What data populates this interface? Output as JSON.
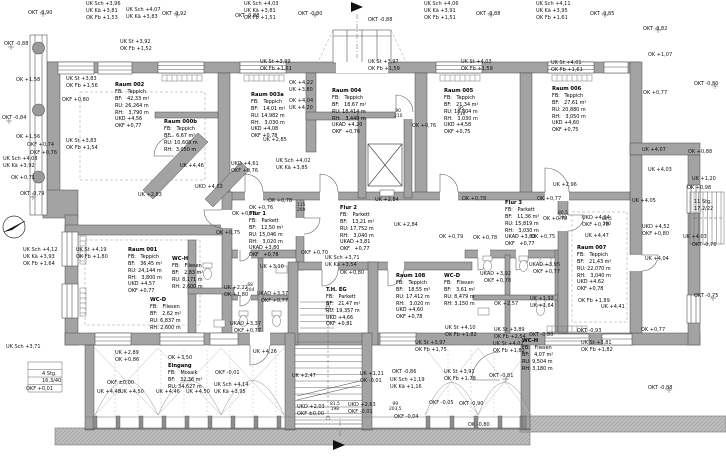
{
  "drawing": {
    "kind": "architectural floor plan",
    "floor_label": "EG"
  },
  "colors": {
    "wall": "#a3a3a3",
    "wall_outline": "#4a4a4a",
    "line": "#3f3f3f",
    "ground": "#bdbdbd",
    "background": "#ffffff"
  },
  "rooms": [
    {
      "name": "Raum 002",
      "x": 115,
      "y": 82,
      "lines": [
        "FB:   Teppich",
        "BF:   42,33 m²",
        "RU: 26,264 m",
        "RH:   3,790 m",
        "UKD +4,56",
        "OKF +0,77"
      ]
    },
    {
      "name": "Raum 000b",
      "x": 164,
      "y": 119,
      "lines": [
        "FB:   Teppich",
        "BF:   6,67 m²",
        "RU: 10,608 m",
        "RH:  3,050 m"
      ]
    },
    {
      "name": "Raum 003a",
      "x": 251,
      "y": 92,
      "lines": [
        "FB:   Teppich",
        "BF:   14,01 m²",
        "RU: 14,982 m",
        "RH:   3,030 m",
        "UKD +4,08",
        "OKF +0,78"
      ]
    },
    {
      "name": "Raum 004",
      "x": 332,
      "y": 88,
      "lines": [
        "FB:   Teppich",
        "BF:   18,67 m²",
        "RU: 18,414 m",
        "RH:   3,440 m",
        "UKAD +4,20",
        "OKF  +0,76"
      ]
    },
    {
      "name": "Raum 005",
      "x": 444,
      "y": 88,
      "lines": [
        "FB:   Teppich",
        "BF:   21,34 m²",
        "RU: 18,804 m",
        "RH:   3,030 m",
        "UKD +4,58",
        "OKF +0,75"
      ]
    },
    {
      "name": "Raum 006",
      "x": 552,
      "y": 86,
      "lines": [
        "FB:   Teppich",
        "BF:   27,61 m²",
        "RU: 20,880 m",
        "RH:   3,050 m",
        "UKD +4,60",
        "OKF +0,75"
      ]
    },
    {
      "name": "Raum 001",
      "x": 128,
      "y": 247,
      "lines": [
        "FB:   Teppich",
        "BF:   36,45 m²",
        "RU: 24,144 m",
        "RH:   3,800 m",
        "UKD +4,57",
        "OKF +0,77"
      ]
    },
    {
      "name": "WC-H",
      "x": 172,
      "y": 256,
      "lines": [
        "FB:   Fliesen",
        "BF:   2,83 m²",
        "RU: 8,171 m",
        "RH: 2,600 m"
      ]
    },
    {
      "name": "WC-D",
      "x": 150,
      "y": 297,
      "lines": [
        "FB:   Fliesen",
        "BF:   2,62 m²",
        "RU: 6,837 m",
        "RH: 2,600 m"
      ]
    },
    {
      "name": "Flur 1",
      "x": 249,
      "y": 211,
      "lines": [
        "FB:   Parkett",
        "BF:   12,50 m²",
        "RU: 15,046 m",
        "RH:   3,020 m",
        "UKAD +3,80",
        "OKF   +0,78"
      ]
    },
    {
      "name": "Flur 2",
      "x": 340,
      "y": 205,
      "lines": [
        "FB:   Parkett",
        "BF:   13,21 m²",
        "RU: 17,752 m",
        "RH:   3,040 m",
        "UKAD +3,81",
        "OKF   +0,77"
      ]
    },
    {
      "name": "Flur 3",
      "x": 505,
      "y": 200,
      "lines": [
        "FB:   Parkett",
        "BF:   11,36 m²",
        "RU: 15,819 m",
        "RH:   3,030 m",
        "UKAD +3,80",
        "OKF   +0,77"
      ]
    },
    {
      "name": "T.H. EG",
      "x": 326,
      "y": 287,
      "lines": [
        "FB:   Parkett",
        "BF:   21,47 m²",
        "RU: 19,357 m",
        "",
        "UKD +4,66",
        "OKF +0,81"
      ]
    },
    {
      "name": "Raum 108",
      "x": 396,
      "y": 273,
      "lines": [
        "FB:   Teppich",
        "BF:   18,55 m²",
        "RU: 17,412 m",
        "RH:   3,020 m",
        "UKD +4,60",
        "OKF +0,78"
      ]
    },
    {
      "name": "WC-D",
      "x": 444,
      "y": 273,
      "lines": [
        "FB:   Fliesen",
        "BF:   3,61 m²",
        "RU: 8,479 m",
        "RH: 3,150 m"
      ]
    },
    {
      "name": "WC-H",
      "x": 522,
      "y": 338,
      "lines": [
        "FB:   Fliesen",
        "BF:   4,07 m²",
        "RU: 9,504 m",
        "RH: 3,180 m"
      ]
    },
    {
      "name": "Raum 007",
      "x": 577,
      "y": 245,
      "lines": [
        "FB:   Teppich",
        "BF:   21,43 m²",
        "RU: 22,070 m",
        "RH:   3,040 m",
        "UKD +4,62",
        "OKF +0,78"
      ]
    },
    {
      "name": "Eingang",
      "x": 168,
      "y": 363,
      "lines": [
        "FB:   Mosaik",
        "BF:   32,36 m²",
        "RU: 34,627 m"
      ]
    }
  ],
  "annotations": [
    {
      "text": "OKT -0,90",
      "x": 28,
      "y": 11
    },
    {
      "text": "UK Sch +3,96",
      "x": 86,
      "y": 2
    },
    {
      "text": "UK Kä  +3,81",
      "x": 86,
      "y": 9
    },
    {
      "text": "OK Fb  +1,53",
      "x": 86,
      "y": 16
    },
    {
      "text": "UK Sch +4,07",
      "x": 126,
      "y": 8
    },
    {
      "text": "UK Kä  +3,83",
      "x": 126,
      "y": 15
    },
    {
      "text": "OKT -0,92",
      "x": 162,
      "y": 12
    },
    {
      "text": "UK Sch +4,03",
      "x": 244,
      "y": 2
    },
    {
      "text": "UK Kä  +3,81",
      "x": 244,
      "y": 9
    },
    {
      "text": "OK Fb  +1,51",
      "x": 244,
      "y": 16
    },
    {
      "text": "OKT -0,88",
      "x": 235,
      "y": 14
    },
    {
      "text": "OKT -0,80",
      "x": 298,
      "y": 12
    },
    {
      "text": "OKT -0,88",
      "x": 368,
      "y": 18
    },
    {
      "text": "UK Sch +4,06",
      "x": 424,
      "y": 2
    },
    {
      "text": "UK Kä  +3,91",
      "x": 424,
      "y": 9
    },
    {
      "text": "OK Fb  +1,51",
      "x": 424,
      "y": 16
    },
    {
      "text": "OKT -0,88",
      "x": 476,
      "y": 12
    },
    {
      "text": "UK Sch +4,11",
      "x": 536,
      "y": 2
    },
    {
      "text": "UK Kä  +3,95",
      "x": 536,
      "y": 9
    },
    {
      "text": "OK Fb  +1,61",
      "x": 536,
      "y": 16
    },
    {
      "text": "OKT -0,85",
      "x": 590,
      "y": 12
    },
    {
      "text": "OKT -0,82",
      "x": 643,
      "y": 27
    },
    {
      "text": "OK +1,07",
      "x": 648,
      "y": 53
    },
    {
      "text": "UK St +3,92",
      "x": 120,
      "y": 40
    },
    {
      "text": "OK Fb +1,52",
      "x": 120,
      "y": 47
    },
    {
      "text": "UK St +3,99",
      "x": 260,
      "y": 60
    },
    {
      "text": "OK Fb +1,61",
      "x": 260,
      "y": 67
    },
    {
      "text": "UK St +3,97",
      "x": 368,
      "y": 60
    },
    {
      "text": "OK Fb +1,59",
      "x": 368,
      "y": 67
    },
    {
      "text": "UK St +4,03",
      "x": 461,
      "y": 60
    },
    {
      "text": "OK Fb +1,59",
      "x": 461,
      "y": 67
    },
    {
      "text": "UK St +4,01",
      "x": 551,
      "y": 61
    },
    {
      "text": "OK Fb +1,61",
      "x": 551,
      "y": 68
    },
    {
      "text": "OKT -0,88",
      "x": 4,
      "y": 42
    },
    {
      "text": "OK +1,58",
      "x": 16,
      "y": 78
    },
    {
      "text": "UK St +3,83",
      "x": 66,
      "y": 77
    },
    {
      "text": "OK Fb +1,56",
      "x": 66,
      "y": 84
    },
    {
      "text": "OKF +0,80",
      "x": 62,
      "y": 98
    },
    {
      "text": "OKT -0,84",
      "x": 2,
      "y": 116
    },
    {
      "text": "OK +1,56",
      "x": 16,
      "y": 135
    },
    {
      "text": "OKF +0,74",
      "x": 27,
      "y": 143
    },
    {
      "text": "OKF +0,76",
      "x": 30,
      "y": 151
    },
    {
      "text": "UK St +3,83",
      "x": 66,
      "y": 139
    },
    {
      "text": "OK Fb +1,54",
      "x": 66,
      "y": 146
    },
    {
      "text": "UK Sch +4,08",
      "x": 3,
      "y": 157
    },
    {
      "text": "UK Kä  +3,92",
      "x": 3,
      "y": 164
    },
    {
      "text": "OK +0,71",
      "x": 11,
      "y": 176
    },
    {
      "text": "OKT -0,79",
      "x": 20,
      "y": 192
    },
    {
      "text": "UK Sch +4,12",
      "x": 23,
      "y": 248
    },
    {
      "text": "UK Kä  +3,93",
      "x": 23,
      "y": 255
    },
    {
      "text": "OK Fb  +1,64",
      "x": 23,
      "y": 262
    },
    {
      "text": "UK St +4,19",
      "x": 76,
      "y": 248
    },
    {
      "text": "OK Fb +1,80",
      "x": 76,
      "y": 255
    },
    {
      "text": "UK +4,46",
      "x": 180,
      "y": 164
    },
    {
      "text": "UKD +4,63",
      "x": 195,
      "y": 185
    },
    {
      "text": "UK +2,83",
      "x": 138,
      "y": 193
    },
    {
      "text": "UKD +4,61",
      "x": 231,
      "y": 162
    },
    {
      "text": "OKF +0,76",
      "x": 231,
      "y": 169
    },
    {
      "text": "UK Sch +4,02",
      "x": 276,
      "y": 159
    },
    {
      "text": "UK Kä  +3,85",
      "x": 276,
      "y": 166
    },
    {
      "text": "OK +4,22",
      "x": 289,
      "y": 81
    },
    {
      "text": "UK +3,80",
      "x": 289,
      "y": 88
    },
    {
      "text": "OK +4,04",
      "x": 289,
      "y": 99
    },
    {
      "text": "UK +4,20",
      "x": 289,
      "y": 106
    },
    {
      "text": "UK +2,85",
      "x": 263,
      "y": 138
    },
    {
      "text": "OK +0,76",
      "x": 249,
      "y": 206
    },
    {
      "text": "OK +0,78",
      "x": 232,
      "y": 212
    },
    {
      "text": "OK +0,75",
      "x": 216,
      "y": 231
    },
    {
      "text": "OK +0,78",
      "x": 268,
      "y": 199
    },
    {
      "text": "UK +2,84",
      "x": 375,
      "y": 198
    },
    {
      "text": "UK +2,84",
      "x": 394,
      "y": 223
    },
    {
      "text": "OK +0,76",
      "x": 412,
      "y": 124
    },
    {
      "text": "OK +0,78",
      "x": 462,
      "y": 197
    },
    {
      "text": "OK +0,77",
      "x": 537,
      "y": 197
    },
    {
      "text": "OK +0,78",
      "x": 543,
      "y": 217
    },
    {
      "text": "OK +0,79",
      "x": 439,
      "y": 235
    },
    {
      "text": "OK +0,78",
      "x": 473,
      "y": 236
    },
    {
      "text": "OK +0,75",
      "x": 531,
      "y": 235
    },
    {
      "text": "UK Sch +3,71",
      "x": 325,
      "y": 256
    },
    {
      "text": "UK Kä  +3,54",
      "x": 325,
      "y": 263
    },
    {
      "text": "OK +0,80",
      "x": 340,
      "y": 271
    },
    {
      "text": "UK +3,10",
      "x": 260,
      "y": 265
    },
    {
      "text": "OKF +0,70",
      "x": 301,
      "y": 251
    },
    {
      "text": "UK +2,22",
      "x": 224,
      "y": 286
    },
    {
      "text": "OK +1,80",
      "x": 224,
      "y": 293
    },
    {
      "text": "UKAD +3,37",
      "x": 257,
      "y": 292
    },
    {
      "text": "OKF   +0,77",
      "x": 261,
      "y": 299
    },
    {
      "text": "UKAD +3,37",
      "x": 230,
      "y": 322
    },
    {
      "text": "OKF   +0,77",
      "x": 234,
      "y": 329
    },
    {
      "text": "UKAD +3,95",
      "x": 529,
      "y": 263
    },
    {
      "text": "OKF   +0,77",
      "x": 533,
      "y": 270
    },
    {
      "text": "UKAD +3,92",
      "x": 480,
      "y": 272
    },
    {
      "text": "OKF   +0,78",
      "x": 484,
      "y": 279
    },
    {
      "text": "OK +2,57",
      "x": 494,
      "y": 302
    },
    {
      "text": "UK +1,92",
      "x": 530,
      "y": 297
    },
    {
      "text": "UK +1,64",
      "x": 530,
      "y": 304
    },
    {
      "text": "UKD +4,64",
      "x": 582,
      "y": 216
    },
    {
      "text": "OKF +0,78",
      "x": 582,
      "y": 223
    },
    {
      "text": "UK +4,47",
      "x": 585,
      "y": 234
    },
    {
      "text": "UKD +4,52",
      "x": 642,
      "y": 225
    },
    {
      "text": "OKF +0,80",
      "x": 642,
      "y": 232
    },
    {
      "text": "UK +4,04",
      "x": 645,
      "y": 257
    },
    {
      "text": "UK +4,05",
      "x": 632,
      "y": 199
    },
    {
      "text": "UK +4,03",
      "x": 648,
      "y": 168
    },
    {
      "text": "UK +4,07",
      "x": 642,
      "y": 148
    },
    {
      "text": "OK +0,88",
      "x": 688,
      "y": 150
    },
    {
      "text": "UK +1,20",
      "x": 692,
      "y": 177
    },
    {
      "text": "OK +0,98",
      "x": 687,
      "y": 186
    },
    {
      "text": "UK +2,96",
      "x": 553,
      "y": 183
    },
    {
      "text": "OK +0,77",
      "x": 643,
      "y": 91
    },
    {
      "text": "OKT -0,80",
      "x": 694,
      "y": 82
    },
    {
      "text": "UK +4,03",
      "x": 683,
      "y": 235
    },
    {
      "text": "OKT -0,76",
      "x": 692,
      "y": 243
    },
    {
      "text": "OKT -0,75",
      "x": 694,
      "y": 294
    },
    {
      "text": "OK Fb +1,89",
      "x": 578,
      "y": 299
    },
    {
      "text": "UK +4,41",
      "x": 601,
      "y": 305
    },
    {
      "text": "OK +0,77",
      "x": 641,
      "y": 328
    },
    {
      "text": "OKT -0,88",
      "x": 648,
      "y": 386
    },
    {
      "text": "11 Stg.",
      "x": 694,
      "y": 200
    },
    {
      "text": "17,2/22",
      "x": 694,
      "y": 207
    },
    {
      "text": "UK St +4,10",
      "x": 445,
      "y": 326
    },
    {
      "text": "OK Fb +1,82",
      "x": 445,
      "y": 333
    },
    {
      "text": "UK St +3,97",
      "x": 415,
      "y": 341
    },
    {
      "text": "OK Fb +1,75",
      "x": 415,
      "y": 348
    },
    {
      "text": "UK St +3,89",
      "x": 494,
      "y": 328
    },
    {
      "text": "OK Fb +2,54",
      "x": 494,
      "y": 335
    },
    {
      "text": "UK St +4,02",
      "x": 493,
      "y": 342
    },
    {
      "text": "OK Fb +1,82",
      "x": 493,
      "y": 349
    },
    {
      "text": "UK St +3,91",
      "x": 444,
      "y": 370
    },
    {
      "text": "OK Fb +1,78",
      "x": 444,
      "y": 377
    },
    {
      "text": "OKT -0,81",
      "x": 489,
      "y": 374
    },
    {
      "text": "OKT -0,86",
      "x": 392,
      "y": 370
    },
    {
      "text": "UK Sch +1,19",
      "x": 390,
      "y": 378
    },
    {
      "text": "UK Kä  +1,16",
      "x": 390,
      "y": 385
    },
    {
      "text": "OKT -0,80",
      "x": 529,
      "y": 333
    },
    {
      "text": "OKT -0,93",
      "x": 577,
      "y": 329
    },
    {
      "text": "UK St +3,81",
      "x": 581,
      "y": 341
    },
    {
      "text": "OK Fb +1,82",
      "x": 581,
      "y": 348
    },
    {
      "text": "OKF -0,05",
      "x": 429,
      "y": 401
    },
    {
      "text": "OKT -0,90",
      "x": 459,
      "y": 402
    },
    {
      "text": "OK -0,80",
      "x": 468,
      "y": 423
    },
    {
      "text": "UK +2,47",
      "x": 292,
      "y": 374
    },
    {
      "text": "UKD +2,03",
      "x": 297,
      "y": 405
    },
    {
      "text": "OKF ±0,00",
      "x": 297,
      "y": 412
    },
    {
      "text": "UKD +2,63",
      "x": 348,
      "y": 403
    },
    {
      "text": "OKF -0,01",
      "x": 348,
      "y": 410
    },
    {
      "text": "UK +1,21",
      "x": 360,
      "y": 372
    },
    {
      "text": "OK -0,01",
      "x": 360,
      "y": 379
    },
    {
      "text": "OKF -0,04",
      "x": 394,
      "y": 415
    },
    {
      "text": "UK +2,89",
      "x": 115,
      "y": 351
    },
    {
      "text": "OK +0,86",
      "x": 115,
      "y": 358
    },
    {
      "text": "OK +3,50",
      "x": 168,
      "y": 356
    },
    {
      "text": "OKF ±0,00",
      "x": 107,
      "y": 381
    },
    {
      "text": "UK +4,48",
      "x": 97,
      "y": 390
    },
    {
      "text": "UK +4,50",
      "x": 120,
      "y": 390
    },
    {
      "text": "UK +4,46",
      "x": 156,
      "y": 390
    },
    {
      "text": "UK +4,50",
      "x": 186,
      "y": 390
    },
    {
      "text": "OKF -0,01",
      "x": 215,
      "y": 371
    },
    {
      "text": "UK Sch +4,14",
      "x": 214,
      "y": 383
    },
    {
      "text": "UK Kä  +3,95",
      "x": 214,
      "y": 390
    },
    {
      "text": "UK Sch +3,71",
      "x": 6,
      "y": 345
    },
    {
      "text": "OKF +0,01",
      "x": 26,
      "y": 387
    },
    {
      "text": "4 Stg.",
      "x": 42,
      "y": 372
    },
    {
      "text": "16,3/40",
      "x": 42,
      "y": 379
    },
    {
      "text": "UK +4,26",
      "x": 253,
      "y": 350
    }
  ],
  "door_tags": [
    {
      "lines": [
        "90",
        "210"
      ],
      "x": 394,
      "y": 110
    },
    {
      "lines": [
        "115",
        "209"
      ],
      "x": 297,
      "y": 204
    },
    {
      "lines": [
        "95",
        "210"
      ],
      "x": 457,
      "y": 108
    },
    {
      "lines": [
        "68",
        "204"
      ],
      "x": 246,
      "y": 284
    },
    {
      "lines": [
        "80,5",
        "200"
      ],
      "x": 558,
      "y": 212
    },
    {
      "lines": [
        "80,5",
        "200"
      ],
      "x": 602,
      "y": 218
    },
    {
      "lines": [
        "81,5",
        "198"
      ],
      "x": 330,
      "y": 403
    },
    {
      "lines": [
        "99",
        "203,5"
      ],
      "x": 389,
      "y": 403
    }
  ]
}
